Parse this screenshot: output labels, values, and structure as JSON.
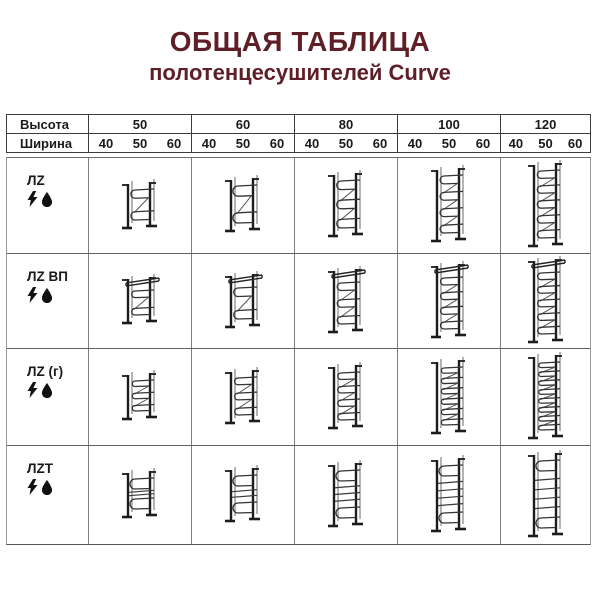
{
  "title": {
    "line1": "ОБЩАЯ ТАБЛИЦА",
    "line2": "полотенцесушителей Curve",
    "color": "#5e1f27"
  },
  "table": {
    "height_label": "Высота",
    "width_label": "Ширина",
    "heights": [
      "50",
      "60",
      "80",
      "100",
      "120"
    ],
    "widths": [
      "40",
      "50",
      "60"
    ]
  },
  "products": {
    "series": "Curve",
    "rows": [
      {
        "model": "ЛZ",
        "features": [
          "lightning-icon",
          "drop-icon"
        ],
        "drawing": "serpentine",
        "variants": [
          {
            "height": "50",
            "loops": 2
          },
          {
            "height": "60",
            "loops": 2
          },
          {
            "height": "80",
            "loops": 3
          },
          {
            "height": "100",
            "loops": 4
          },
          {
            "height": "120",
            "loops": 5
          }
        ]
      },
      {
        "model": "ЛZ ВП",
        "features": [
          "lightning-icon",
          "drop-icon"
        ],
        "drawing": "shelf",
        "variants": [
          {
            "height": "50",
            "loops": 2
          },
          {
            "height": "60",
            "loops": 2
          },
          {
            "height": "80",
            "loops": 3
          },
          {
            "height": "100",
            "loops": 4
          },
          {
            "height": "120",
            "loops": 5
          }
        ]
      },
      {
        "model": "ЛZ (г)",
        "features": [
          "lightning-icon",
          "drop-icon"
        ],
        "drawing": "serpentine",
        "variants": [
          {
            "height": "50",
            "loops": 3
          },
          {
            "height": "60",
            "loops": 3
          },
          {
            "height": "80",
            "loops": 4
          },
          {
            "height": "100",
            "loops": 6
          },
          {
            "height": "120",
            "loops": 8
          }
        ]
      },
      {
        "model": "ЛZT",
        "features": [
          "lightning-icon",
          "drop-icon"
        ],
        "drawing": "rungs",
        "variants": [
          {
            "height": "50",
            "loops": 2
          },
          {
            "height": "60",
            "loops": 2
          },
          {
            "height": "80",
            "loops": 3
          },
          {
            "height": "100",
            "loops": 4
          },
          {
            "height": "120",
            "loops": 4
          }
        ]
      }
    ]
  }
}
